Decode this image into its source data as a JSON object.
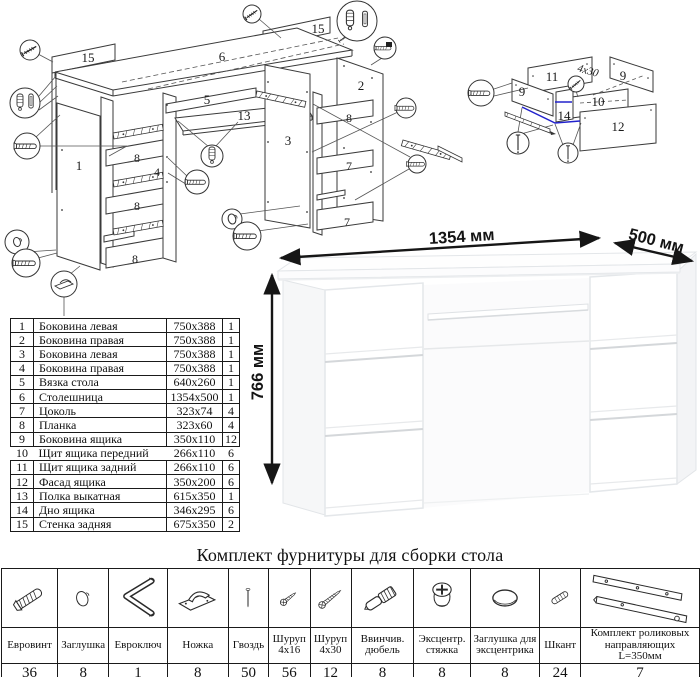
{
  "title": "Комплект фурнитуры для сборки стола",
  "colors": {
    "highlight_blue": "#2222cc",
    "line_art": "#333333",
    "dimension_text": "#141414"
  },
  "dimensions": {
    "width": "1354 мм",
    "depth": "500 мм",
    "height": "766 мм"
  },
  "diagram": {
    "main_labels": [
      "15",
      "6",
      "15",
      "5",
      "13",
      "2",
      "1",
      "8",
      "4",
      "3",
      "8",
      "8",
      "7",
      "8",
      "7"
    ],
    "drawer_labels": [
      "11",
      "9",
      "4x30",
      "9",
      "10",
      "14",
      "12"
    ]
  },
  "parts": {
    "rows": [
      {
        "num": "1",
        "name": "Боковина левая",
        "size": "750x388",
        "qty": "1"
      },
      {
        "num": "2",
        "name": "Боковина правая",
        "size": "750x388",
        "qty": "1"
      },
      {
        "num": "3",
        "name": "Боковина левая",
        "size": "750x388",
        "qty": "1"
      },
      {
        "num": "4",
        "name": "Боковина правая",
        "size": "750x388",
        "qty": "1"
      },
      {
        "num": "5",
        "name": "Вязка стола",
        "size": "640x260",
        "qty": "1"
      },
      {
        "num": "6",
        "name": "Столешница",
        "size": "1354x500",
        "qty": "1"
      },
      {
        "num": "7",
        "name": "Цоколь",
        "size": "323x74",
        "qty": "4"
      },
      {
        "num": "8",
        "name": "Планка",
        "size": "323x60",
        "qty": "4"
      },
      {
        "num": "9",
        "name": "Боковина ящика",
        "size": "350x110",
        "qty": "12"
      },
      {
        "num": "10",
        "name": "Щит ящика передний",
        "size": "266x110",
        "qty": "6"
      },
      {
        "num": "11",
        "name": "Щит ящика задний",
        "size": "266x110",
        "qty": "6"
      },
      {
        "num": "12",
        "name": "Фасад ящика",
        "size": "350x200",
        "qty": "6"
      },
      {
        "num": "13",
        "name": "Полка выкатная",
        "size": "615x350",
        "qty": "1"
      },
      {
        "num": "14",
        "name": "Дно ящика",
        "size": "346x295",
        "qty": "6"
      },
      {
        "num": "15",
        "name": "Стенка задняя",
        "size": "675x350",
        "qty": "2"
      }
    ]
  },
  "hardware": {
    "items": [
      {
        "icon": "confirmat-screw-icon",
        "name": "Евровинт",
        "qty": "36"
      },
      {
        "icon": "cap-icon",
        "name": "Заглушка",
        "qty": "8"
      },
      {
        "icon": "hex-key-icon",
        "name": "Евроключ",
        "qty": "1"
      },
      {
        "icon": "foot-icon",
        "name": "Ножка",
        "qty": "8"
      },
      {
        "icon": "nail-icon",
        "name": "Гвоздь",
        "qty": "50"
      },
      {
        "icon": "screw-short-icon",
        "name": "Шуруп 4x16",
        "qty": "56"
      },
      {
        "icon": "screw-long-icon",
        "name": "Шуруп 4x30",
        "qty": "12"
      },
      {
        "icon": "threaded-dowel-icon",
        "name": "Ввинчив. дюбель",
        "qty": "8"
      },
      {
        "icon": "cam-lock-icon",
        "name": "Эксцентр. стяжка",
        "qty": "8"
      },
      {
        "icon": "cam-cap-icon",
        "name": "Заглушка для эксцентрика",
        "qty": "8"
      },
      {
        "icon": "wood-dowel-icon",
        "name": "Шкант",
        "qty": "24"
      },
      {
        "icon": "roller-guides-icon",
        "name": "Комплект роликовых направляющих L=350мм",
        "qty": "7"
      }
    ]
  }
}
